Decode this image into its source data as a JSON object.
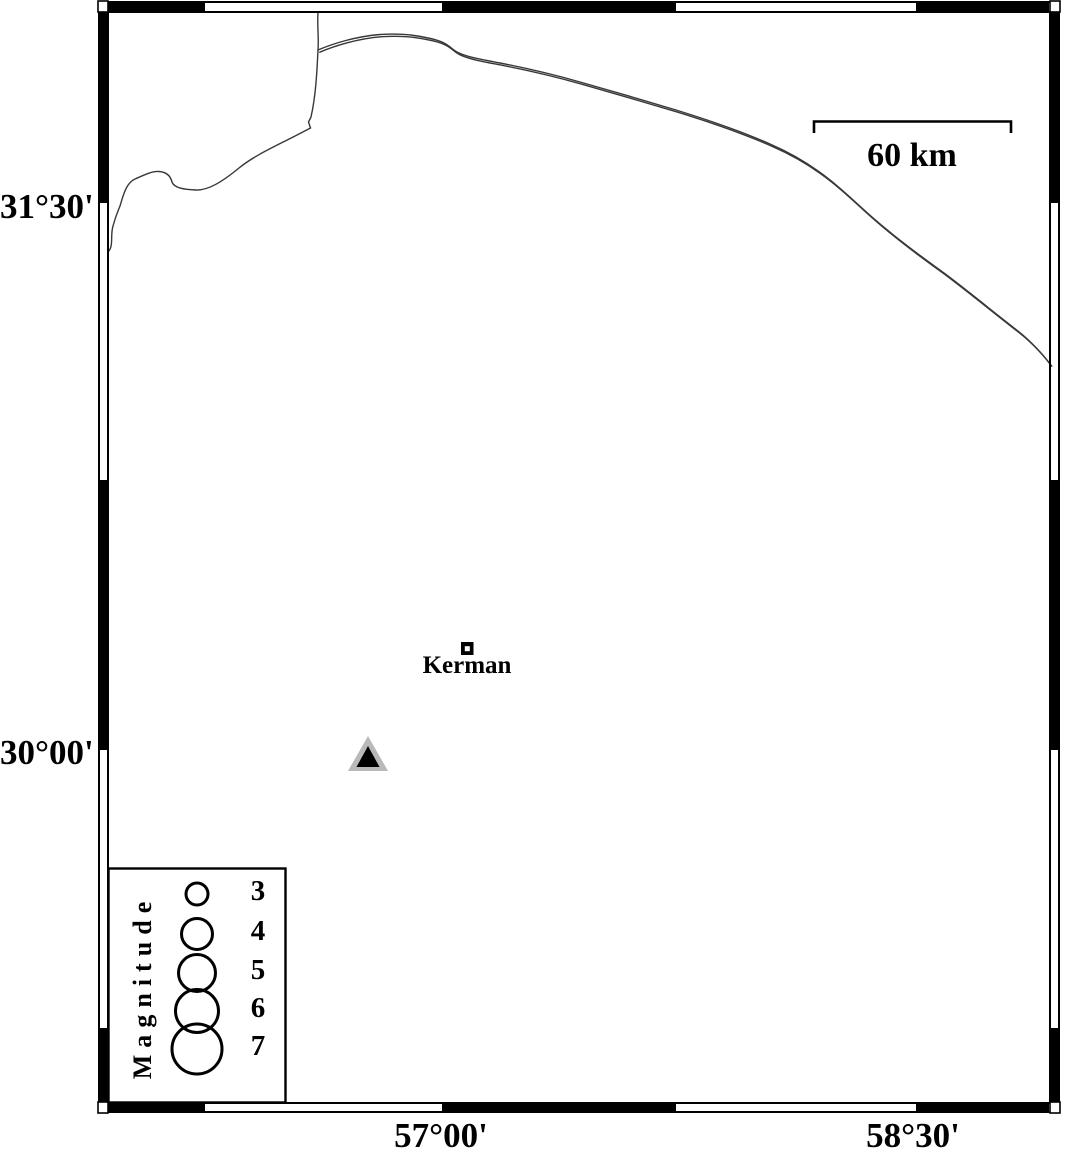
{
  "map": {
    "lat_labels": [
      {
        "text": "31°30'"
      },
      {
        "text": "30°00'"
      }
    ],
    "lon_labels": [
      {
        "text": "57°00'"
      },
      {
        "text": "58°30'"
      }
    ],
    "scale_bar": {
      "label": "60 km"
    },
    "city": {
      "label": "Kerman",
      "icon": "square-icon"
    },
    "station": {
      "icon": "triangle-icon",
      "fill": "#b9b9b9",
      "inner_fill": "#000000"
    }
  },
  "legend": {
    "title": "Magnitude",
    "items": [
      {
        "label": "3",
        "r": 11
      },
      {
        "label": "4",
        "r": 15.5
      },
      {
        "label": "5",
        "r": 18.5
      },
      {
        "label": "6",
        "r": 21.5
      },
      {
        "label": "7",
        "r": 25
      }
    ]
  },
  "colors": {
    "frame": "#000000",
    "line": "#383838",
    "background": "#ffffff"
  }
}
